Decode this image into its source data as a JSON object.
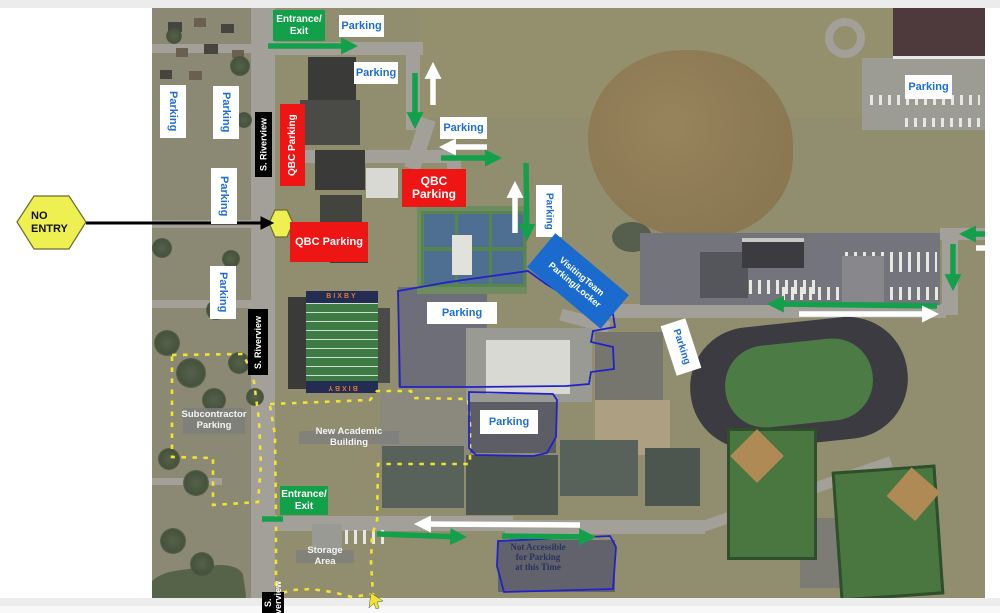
{
  "map": {
    "title": "Campus parking map (aerial)",
    "stadium_text": "BIXBY",
    "colors": {
      "green": "#13a04b",
      "red": "#ee1515",
      "label_blue": "#1d6fd6",
      "visiting_blue": "#1a6bcd",
      "navy_text": "#27335e",
      "yellow": "#f2e42e",
      "blue_line": "#2321c9",
      "white": "#ffffff",
      "black": "#000000"
    }
  },
  "annotations": {
    "boxes": [
      {
        "id": "entrance-exit-top",
        "type": "green",
        "text": "Entrance/\nExit",
        "x": 273,
        "y": 10,
        "w": 52,
        "h": 31
      },
      {
        "id": "parking-top-1",
        "type": "white",
        "text": "Parking",
        "x": 339,
        "y": 15,
        "w": 45,
        "h": 22
      },
      {
        "id": "parking-top-2",
        "type": "white",
        "text": "Parking",
        "x": 354,
        "y": 62,
        "w": 44,
        "h": 22
      },
      {
        "id": "parking-top-3",
        "type": "white",
        "text": "Parking",
        "x": 440,
        "y": 117,
        "w": 47,
        "h": 22
      },
      {
        "id": "parking-left-1",
        "type": "white",
        "text": "Parking",
        "x": 160,
        "y": 85,
        "w": 26,
        "h": 53,
        "vertical": true
      },
      {
        "id": "parking-left-2",
        "type": "white",
        "text": "Parking",
        "x": 213,
        "y": 86,
        "w": 26,
        "h": 53,
        "vertical": true
      },
      {
        "id": "parking-left-3",
        "type": "white",
        "text": "Parking",
        "x": 211,
        "y": 168,
        "w": 26,
        "h": 56,
        "vertical": true
      },
      {
        "id": "parking-left-4",
        "type": "white",
        "text": "Parking",
        "x": 210,
        "y": 266,
        "w": 26,
        "h": 53,
        "vertical": true
      },
      {
        "id": "qbc-parking-vertical",
        "type": "red",
        "text": "QBC Parking",
        "x": 280,
        "y": 104,
        "w": 25,
        "h": 82,
        "vertical": true,
        "up": true,
        "fs": 10
      },
      {
        "id": "s-riverview-1",
        "type": "black",
        "text": "S. Riverview",
        "x": 255,
        "y": 112,
        "w": 17,
        "h": 65,
        "vertical": true,
        "up": true
      },
      {
        "id": "s-riverview-2",
        "type": "black",
        "text": "S. Riverview",
        "x": 248,
        "y": 309,
        "w": 20,
        "h": 66,
        "vertical": true,
        "up": true
      },
      {
        "id": "s-riverview-3",
        "type": "black",
        "text": "S. Riverview",
        "x": 262,
        "y": 592,
        "w": 22,
        "h": 21,
        "vertical": true,
        "up": true
      },
      {
        "id": "qbc-parking-mid",
        "type": "red",
        "text": "QBC Parking",
        "x": 290,
        "y": 222,
        "w": 78,
        "h": 40
      },
      {
        "id": "qbc-parking-2",
        "type": "red",
        "text": "QBC\nParking",
        "x": 402,
        "y": 169,
        "w": 64,
        "h": 38,
        "fs": 12
      },
      {
        "id": "parking-courts",
        "type": "white",
        "text": "Parking",
        "x": 536,
        "y": 185,
        "w": 26,
        "h": 52,
        "vertical": true,
        "fs": 10
      },
      {
        "id": "visiting-team",
        "type": "blue",
        "text": "VisitingTeam\nParking/Locker",
        "x": 530,
        "y": 259,
        "w": 96,
        "h": 44,
        "rotate": 40
      },
      {
        "id": "parking-main-lot",
        "type": "white",
        "text": "Parking",
        "x": 427,
        "y": 302,
        "w": 70,
        "h": 22
      },
      {
        "id": "parking-lot-2",
        "type": "white",
        "text": "Parking",
        "x": 480,
        "y": 410,
        "w": 58,
        "h": 24
      },
      {
        "id": "parking-track",
        "type": "white",
        "text": "Parking",
        "x": 655,
        "y": 334,
        "w": 52,
        "h": 26,
        "rotate": 72,
        "fs": 10
      },
      {
        "id": "parking-top-right",
        "type": "white",
        "text": "Parking",
        "x": 905,
        "y": 75,
        "w": 47,
        "h": 24
      },
      {
        "id": "subcontractor-parking",
        "type": "gray",
        "text": "Subcontractor\nParking",
        "x": 183,
        "y": 408,
        "w": 62,
        "h": 26
      },
      {
        "id": "new-academic-building",
        "type": "gray",
        "text": "New Academic Building",
        "x": 299,
        "y": 431,
        "w": 100,
        "h": 13
      },
      {
        "id": "storage-area",
        "type": "gray",
        "text": "Storage Area",
        "x": 296,
        "y": 550,
        "w": 58,
        "h": 13
      },
      {
        "id": "entrance-exit-bottom",
        "type": "green",
        "text": "Entrance/\nExit",
        "x": 280,
        "y": 486,
        "w": 48,
        "h": 29
      },
      {
        "id": "not-accessible-note",
        "type": "navy-text",
        "text": "Not Accessible\nfor Parking\nat this Time",
        "x": 506,
        "y": 541,
        "w": 64,
        "h": 32
      },
      {
        "id": "no-entry",
        "type": "hex-label",
        "text": "NO\nENTRY",
        "x": 17,
        "y": 196,
        "w": 69,
        "h": 53
      }
    ],
    "arrows": [
      {
        "id": "flow-top-east",
        "color": "green",
        "x1": 268,
        "y1": 46,
        "x2": 353,
        "y2": 46
      },
      {
        "id": "flow-down-1",
        "color": "green",
        "x1": 415,
        "y1": 73,
        "x2": 415,
        "y2": 124
      },
      {
        "id": "flow-up-1",
        "color": "white",
        "x1": 433,
        "y1": 105,
        "x2": 433,
        "y2": 67
      },
      {
        "id": "flow-west-1",
        "color": "white",
        "x1": 487,
        "y1": 147,
        "x2": 444,
        "y2": 147
      },
      {
        "id": "flow-east-1",
        "color": "green",
        "x1": 441,
        "y1": 158,
        "x2": 497,
        "y2": 158
      },
      {
        "id": "flow-up-2",
        "color": "white",
        "x1": 515,
        "y1": 233,
        "x2": 515,
        "y2": 186
      },
      {
        "id": "flow-down-2",
        "color": "green",
        "x1": 526,
        "y1": 163,
        "x2": 527,
        "y2": 236
      },
      {
        "id": "no-entry-pointer",
        "color": "black",
        "x1": 86,
        "y1": 223,
        "x2": 270,
        "y2": 223
      },
      {
        "id": "flow-west-bottom",
        "color": "white",
        "x1": 580,
        "y1": 525,
        "x2": 419,
        "y2": 524
      },
      {
        "id": "flow-east-bottom-1",
        "color": "green",
        "x1": 377,
        "y1": 534,
        "x2": 462,
        "y2": 537
      },
      {
        "id": "flow-east-bottom-2",
        "color": "green",
        "x1": 502,
        "y1": 536,
        "x2": 591,
        "y2": 537
      },
      {
        "id": "flow-west-right-road",
        "color": "green",
        "x1": 937,
        "y1": 306,
        "x2": 772,
        "y2": 304
      },
      {
        "id": "flow-east-right-road",
        "color": "white",
        "x1": 799,
        "y1": 314,
        "x2": 934,
        "y2": 314
      },
      {
        "id": "flow-west-top-right",
        "color": "green",
        "x1": 985,
        "y1": 234,
        "x2": 964,
        "y2": 234
      },
      {
        "id": "flow-down-right",
        "color": "green",
        "x1": 953,
        "y1": 244,
        "x2": 953,
        "y2": 286
      },
      {
        "id": "green-bar-entrance",
        "color": "green-bar",
        "x1": 262,
        "y1": 519,
        "x2": 283,
        "y2": 519
      },
      {
        "id": "white-bar-edge",
        "color": "white-bar",
        "x1": 976,
        "y1": 248,
        "x2": 985,
        "y2": 248
      }
    ],
    "yellow_paths": [
      {
        "id": "subcontractor-boundary",
        "d": "M172,355 L243,354 L253,375 L259,420 L261,465 L258,502 L213,505 L213,458 L172,457 Z"
      },
      {
        "id": "riverview-east-line",
        "d": "M270,406 L275,435 L276,520 L276,600"
      },
      {
        "id": "academic-storage-boundary",
        "d": "M270,404 L370,400 L377,391 L411,391 L413,398 L468,399 L470,425 L470,464 L378,464 L377,522 L372,534 L371,562 L373,594 L352,597 L332,592 L311,589 L293,590 L278,594"
      }
    ],
    "blue_paths": [
      {
        "id": "main-lot-outline",
        "d": "M398,291 L449,282 L528,271 L546,284 L571,299 L599,309 L613,314 L615,327 L593,331 L591,342 L613,347 L614,369 L591,372 L589,384 L566,386 L470,387 L400,387 Z"
      },
      {
        "id": "lot2-outline",
        "d": "M469,392 L553,394 L557,400 L556,437 L547,453 L533,456 L476,455 L469,448 Z"
      },
      {
        "id": "not-accessible-outline",
        "d": "M498,541 L610,536 L616,547 L613,589 L504,592 L497,566 Z"
      }
    ],
    "hexagons": [
      {
        "id": "no-entry-hexagon",
        "points": "34,196 69,196 86,222 69,249 34,249 17,222"
      },
      {
        "id": "no-entry-spot",
        "points": "275,210 287,210 293,223 287,237 275,237 269,223"
      }
    ],
    "cursor": {
      "id": "yellow-end-arrow",
      "d": "M371,593 l12,8 -6,1 2,6 -3,1 -2,-6 -5,5 z"
    }
  }
}
